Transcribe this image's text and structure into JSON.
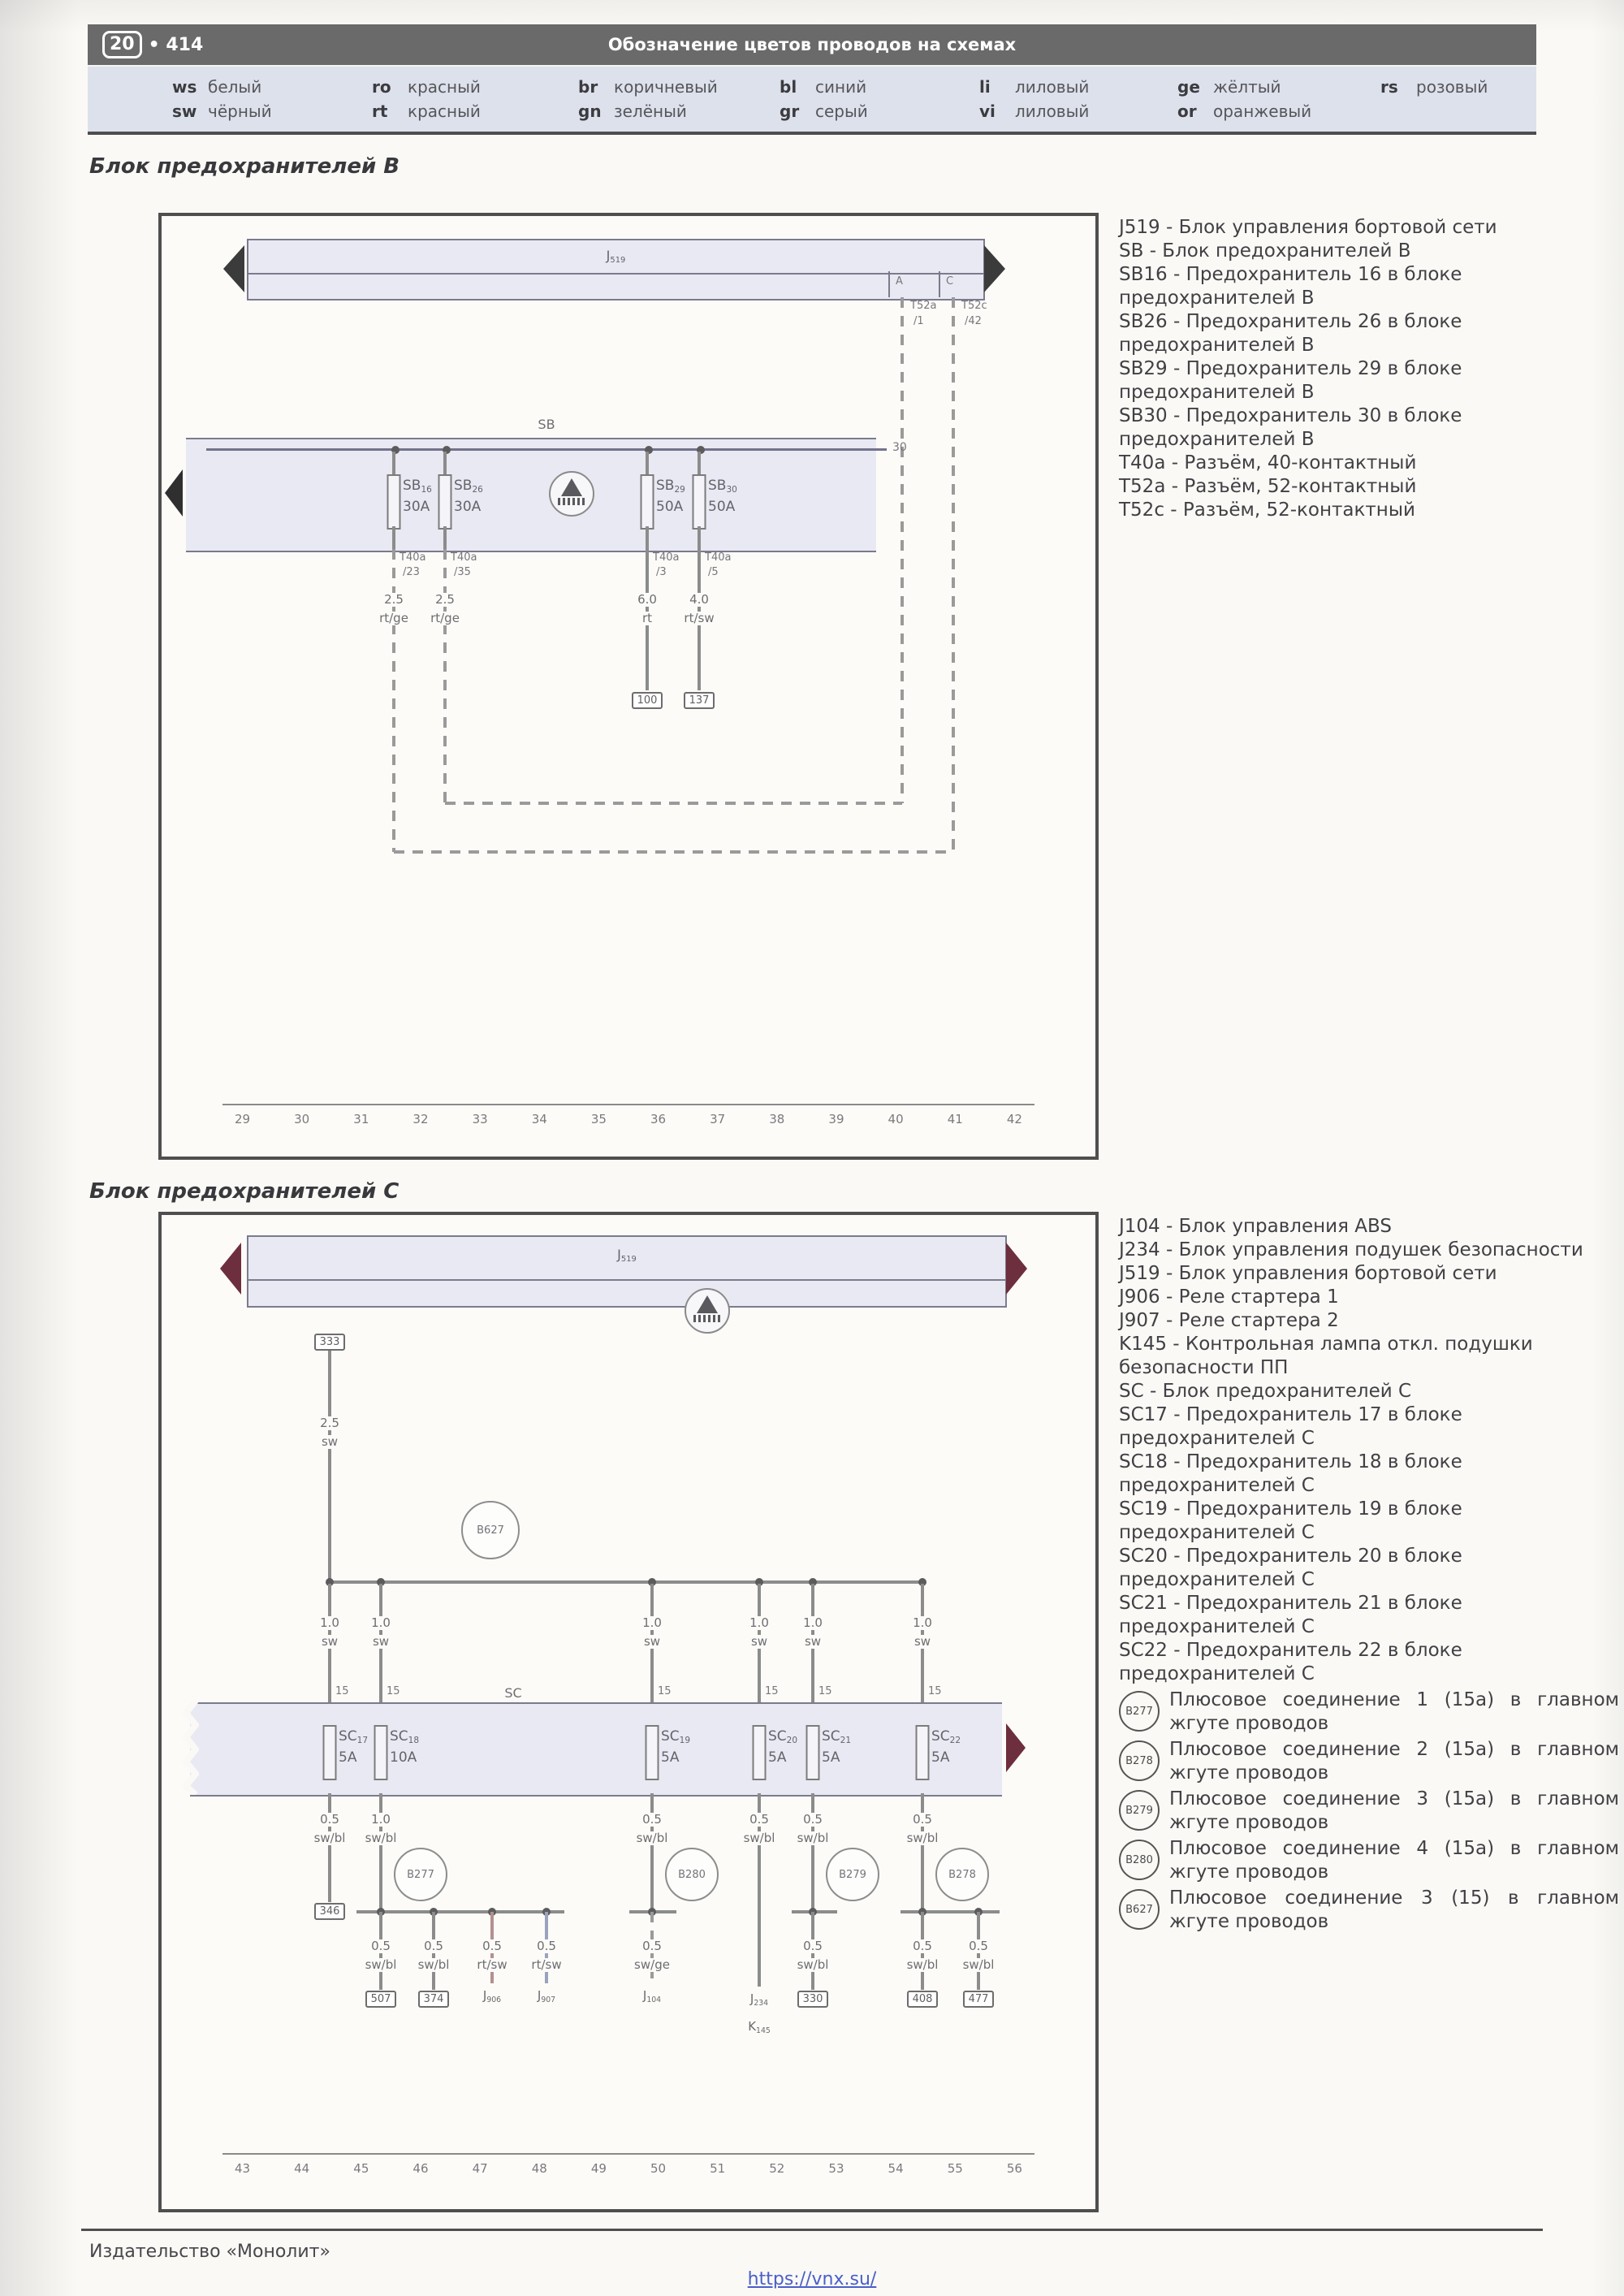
{
  "page": {
    "badge": "20",
    "page_number": "• 414",
    "header_title": "Обозначение цветов проводов на схемах",
    "footer_publisher": "Издательство «Монолит»",
    "footer_link": "https://vnx.su/"
  },
  "wire_colors": {
    "columns": [
      [
        {
          "code": "ws",
          "name": "белый"
        },
        {
          "code": "sw",
          "name": "чёрный"
        }
      ],
      [
        {
          "code": "ro",
          "name": "красный"
        },
        {
          "code": "rt",
          "name": "красный"
        }
      ],
      [
        {
          "code": "br",
          "name": "коричневый"
        },
        {
          "code": "gn",
          "name": "зелёный"
        }
      ],
      [
        {
          "code": "bl",
          "name": "синий"
        },
        {
          "code": "gr",
          "name": "серый"
        }
      ],
      [
        {
          "code": "li",
          "name": "лиловый"
        },
        {
          "code": "vi",
          "name": "лиловый"
        }
      ],
      [
        {
          "code": "ge",
          "name": "жёлтый"
        },
        {
          "code": "or",
          "name": "оранжевый"
        }
      ],
      [
        {
          "code": "rs",
          "name": "розовый"
        }
      ]
    ]
  },
  "section_b": {
    "title": "Блок предохранителей B",
    "legend": [
      {
        "text": "J519 - Блок управления бортовой сети"
      },
      {
        "text": "SB - Блок предохранителей B"
      },
      {
        "text": "SB16 - Предохранитель 16 в блоке предохранителей B"
      },
      {
        "text": "SB26 - Предохранитель 26 в блоке предохранителей B"
      },
      {
        "text": "SB29 - Предохранитель 29 в блоке предохранителей B"
      },
      {
        "text": "SB30 - Предохранитель 30 в блоке предохранителей B"
      },
      {
        "text": "T40a - Разъём, 40-контактный"
      },
      {
        "text": "T52a - Разъём, 52-контактный"
      },
      {
        "text": "T52c - Разъём, 52-контактный"
      }
    ],
    "diagram": {
      "j519": {
        "p": "J",
        "s": "519"
      },
      "cell_a": "A",
      "cell_c": "C",
      "conn_a": {
        "name": "T52a",
        "pin": "/1"
      },
      "conn_c": {
        "name": "T52c",
        "pin": "/42"
      },
      "sb": "SB",
      "terminal": "30",
      "fuses": [
        {
          "p": "SB",
          "s": "16",
          "amp": "30A",
          "conn": "T40a",
          "pin": "/23",
          "gauge": "2.5",
          "color": "rt/ge"
        },
        {
          "p": "SB",
          "s": "26",
          "amp": "30A",
          "conn": "T40a",
          "pin": "/35",
          "gauge": "2.5",
          "color": "rt/ge"
        },
        {
          "p": "SB",
          "s": "29",
          "amp": "50A",
          "conn": "T40a",
          "pin": "/3",
          "gauge": "6.0",
          "color": "rt",
          "dest": "100"
        },
        {
          "p": "SB",
          "s": "30",
          "amp": "50A",
          "conn": "T40a",
          "pin": "/5",
          "gauge": "4.0",
          "color": "rt/sw",
          "dest": "137"
        }
      ],
      "tracks": [
        "29",
        "30",
        "31",
        "32",
        "33",
        "34",
        "35",
        "36",
        "37",
        "38",
        "39",
        "40",
        "41",
        "42"
      ]
    }
  },
  "section_c": {
    "title": "Блок предохранителей C",
    "legend": [
      {
        "text": "J104 - Блок управления ABS"
      },
      {
        "text": "J234 - Блок управления подушек безопасности"
      },
      {
        "text": "J519 - Блок управления бортовой сети"
      },
      {
        "text": "J906 - Реле стартера 1"
      },
      {
        "text": "J907 - Реле стартера 2"
      },
      {
        "text": "K145 - Контрольная лампа откл. подушки безопасности ПП"
      },
      {
        "text": "SC - Блок предохранителей C"
      },
      {
        "text": "SC17 - Предохранитель 17 в блоке предохранителей C"
      },
      {
        "text": "SC18 - Предохранитель 18 в блоке предохранителей C"
      },
      {
        "text": "SC19 - Предохранитель 19 в блоке предохранителей C"
      },
      {
        "text": "SC20 - Предохранитель 20 в блоке предохранителей C"
      },
      {
        "text": "SC21 - Предохранитель 21 в блоке предохранителей C"
      },
      {
        "text": "SC22 - Предохранитель 22 в блоке предохранителей C"
      }
    ],
    "plus_connections": [
      {
        "code": "B277",
        "desc": "Плюсовое соединение 1 (15a) в главном жгуте проводов"
      },
      {
        "code": "B278",
        "desc": "Плюсовое соединение 2 (15a) в главном жгуте проводов"
      },
      {
        "code": "B279",
        "desc": "Плюсовое соединение 3 (15a) в главном жгуте проводов"
      },
      {
        "code": "B280",
        "desc": "Плюсовое соединение 4 (15a) в главном жгуте проводов"
      },
      {
        "code": "B627",
        "desc": "Плюсовое соединение 3 (15) в главном жгуте проводов"
      }
    ],
    "diagram": {
      "j519": {
        "p": "J",
        "s": "519"
      },
      "box333": "333",
      "wire333": {
        "gauge": "2.5",
        "color": "sw"
      },
      "b627": "B627",
      "sc": "SC",
      "pin15": "15",
      "upper": {
        "gauge": "1.0",
        "color": "sw"
      },
      "fuses": [
        {
          "p": "SC",
          "s": "17",
          "amp": "5A"
        },
        {
          "p": "SC",
          "s": "18",
          "amp": "10A"
        },
        {
          "p": "SC",
          "s": "19",
          "amp": "5A"
        },
        {
          "p": "SC",
          "s": "20",
          "amp": "5A"
        },
        {
          "p": "SC",
          "s": "21",
          "amp": "5A"
        },
        {
          "p": "SC",
          "s": "22",
          "amp": "5A"
        }
      ],
      "below": {
        "col1": {
          "g": "0.5",
          "c": "sw/bl",
          "box": "346"
        },
        "col2": {
          "g": "1.0",
          "c": "sw/bl",
          "node": "B277",
          "drops": [
            {
              "g": "0.5",
              "c": "sw/bl",
              "box": "507"
            },
            {
              "g": "0.5",
              "c": "sw/bl",
              "box": "374"
            },
            {
              "g": "0.5",
              "c": "rt/sw",
              "lp": "J",
              "ls": "906"
            },
            {
              "g": "0.5",
              "c": "rt/sw",
              "lp": "J",
              "ls": "907"
            }
          ]
        },
        "col3": {
          "g": "0.5",
          "c": "sw/bl",
          "node": "B280",
          "drop": {
            "g": "0.5",
            "c": "sw/ge",
            "lp": "J",
            "ls": "104"
          }
        },
        "col4": {
          "g": "0.5",
          "c": "sw/bl",
          "lp": "J",
          "ls": "234",
          "lp2": "K",
          "ls2": "145"
        },
        "col5": {
          "g": "0.5",
          "c": "sw/bl",
          "node": "B279",
          "drop": {
            "g": "0.5",
            "c": "sw/bl",
            "box": "330"
          }
        },
        "col6": {
          "g": "0.5",
          "c": "sw/bl",
          "node": "B278",
          "drops": [
            {
              "g": "0.5",
              "c": "sw/bl",
              "box": "408"
            },
            {
              "g": "0.5",
              "c": "sw/bl",
              "box": "477"
            }
          ]
        }
      },
      "tracks": [
        "43",
        "44",
        "45",
        "46",
        "47",
        "48",
        "49",
        "50",
        "51",
        "52",
        "53",
        "54",
        "55",
        "56"
      ]
    }
  }
}
